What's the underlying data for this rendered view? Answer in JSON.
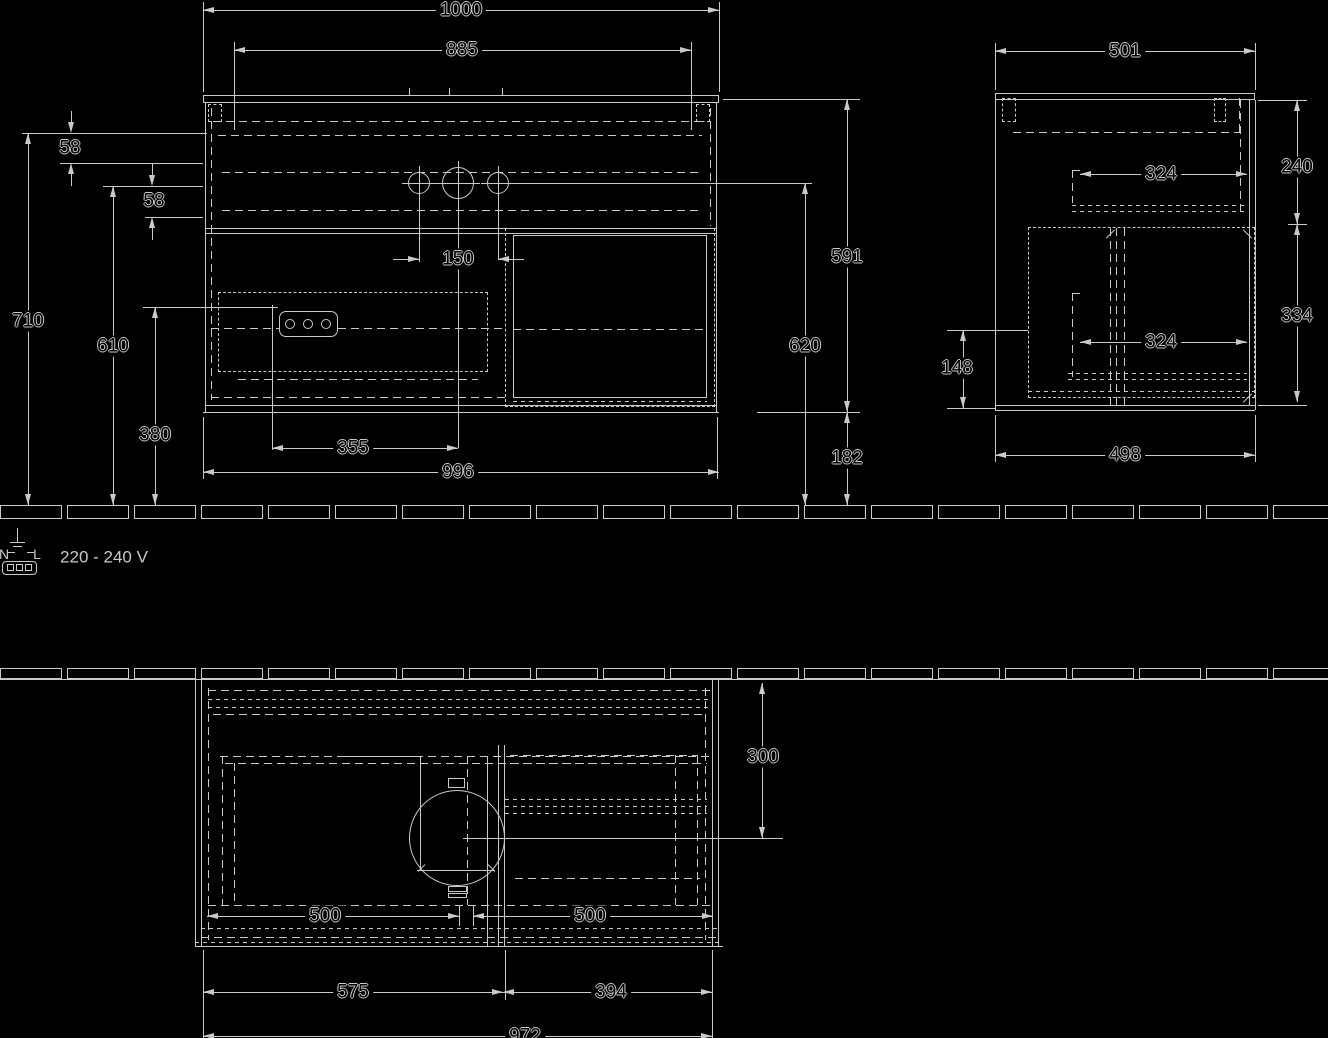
{
  "title": "wall-hung vanity unit technical drawing",
  "views": {
    "front": {
      "width_top": "1000",
      "inner_width": "885",
      "offset_top_a": "58",
      "offset_top_b": "58",
      "height_overall": "710",
      "height_mid": "610",
      "height_socket": "380",
      "tap_hole_spacing": "150",
      "drain_offset": "355",
      "cabinet_width": "996",
      "cabinet_height": "591",
      "height_taps_to_floor": "620",
      "floor_gap": "182"
    },
    "side": {
      "depth_top": "501",
      "upper_section_height": "240",
      "drawer_depth_upper": "324",
      "drawer_depth_lower": "324",
      "lower_section_height": "334",
      "siphon_height": "148",
      "cabinet_depth": "498"
    },
    "plan": {
      "depth_front": "300",
      "drawer_width_left": "500",
      "drawer_width_right": "500",
      "section_left": "575",
      "section_right": "394",
      "overall_width": "972"
    },
    "power": {
      "voltage": "220 - 240 V",
      "neutral": "N",
      "line": "L"
    }
  }
}
